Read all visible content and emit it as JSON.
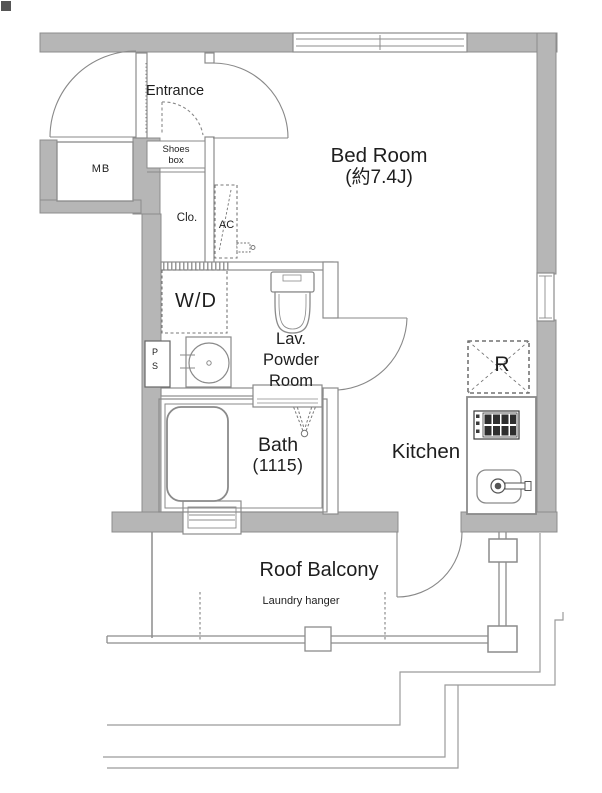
{
  "floor_plan": {
    "labels": {
      "entrance": "Entrance",
      "shoes_box": "Shoes box",
      "meter_box": "MB",
      "closet": "Clo.",
      "air_conditioner": "AC",
      "bed_room": "Bed Room",
      "bed_room_size": "(約7.4J)",
      "washer_dryer": "W/D",
      "pipe_space": "P S",
      "lavatory_powder_room": "Lav. Powder Room",
      "bath": "Bath",
      "bath_size": "(1115)",
      "kitchen": "Kitchen",
      "refrigerator_space": "R",
      "roof_balcony": "Roof Balcony",
      "laundry_hanger": "Laundry hanger"
    },
    "colors": {
      "background": "#ffffff",
      "wall_fill": "#b6b6b6",
      "wall_edge": "#8c8c8c",
      "line": "#8a8a8a",
      "text": "#1e1e1e"
    }
  }
}
